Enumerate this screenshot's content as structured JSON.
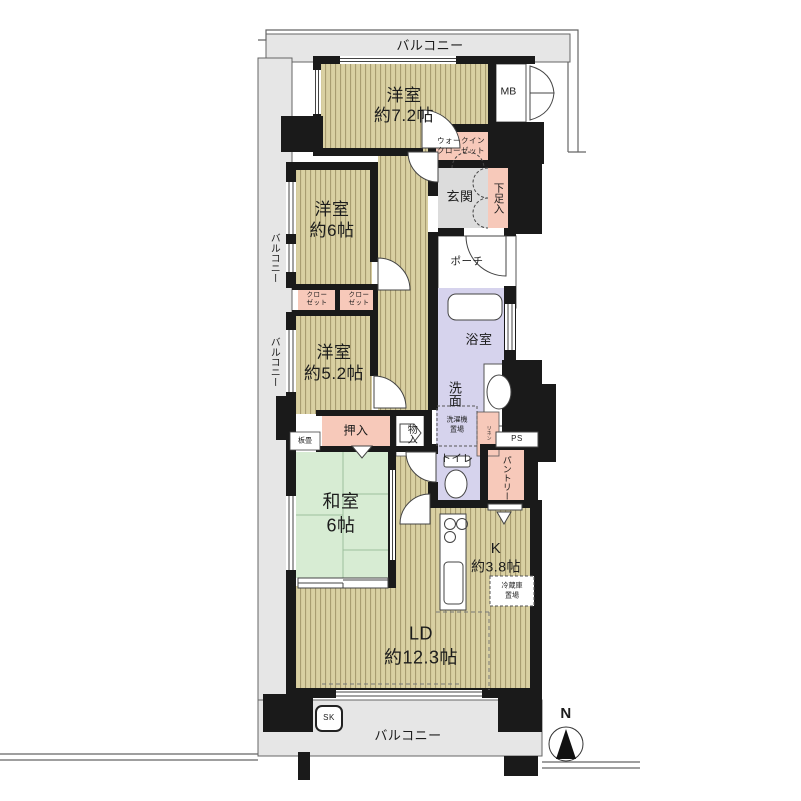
{
  "plan": {
    "balcony": "バルコニー",
    "rooms": {
      "western": "洋室",
      "w72_size": "約7.2帖",
      "w6_size": "約6帖",
      "w52_size": "約5.2帖",
      "washitsu": "和室",
      "washitsu_size": "6帖",
      "ld": "LD",
      "ld_size": "約12.3帖",
      "kitchen": "K",
      "kitchen_size": "約3.8帖"
    },
    "features": {
      "mb": "MB",
      "wic1": "ウォークイン",
      "wic2": "クローゼット",
      "genkan": "玄関",
      "shoes": "下足入",
      "porch": "ポーチ",
      "bath": "浴室",
      "vanity": "洗面",
      "laundry1": "洗濯機",
      "laundry2": "置場",
      "linen": "リネン",
      "ps": "PS",
      "toilet": "トイレ",
      "pantry": "パントリー",
      "oshiire": "押入",
      "monoire": "物入",
      "itatami": "板畳",
      "closet1": "クロー",
      "closet2": "ゼット",
      "fridge1": "冷蔵庫",
      "fridge2": "置場",
      "sk": "SK"
    },
    "compass": {
      "north": "N"
    }
  },
  "colors": {
    "wall": "#1a1a1a",
    "stripe_floor": "#d9d0a2",
    "stripe_line": "#a2976b",
    "tatami_green": "#d7ecd3",
    "closet_pink": "#f7c9ba",
    "wet_lavender": "#d6d3ed",
    "balcony_gray": "#e6e6e6",
    "entry_gray": "#dcdcdc"
  }
}
